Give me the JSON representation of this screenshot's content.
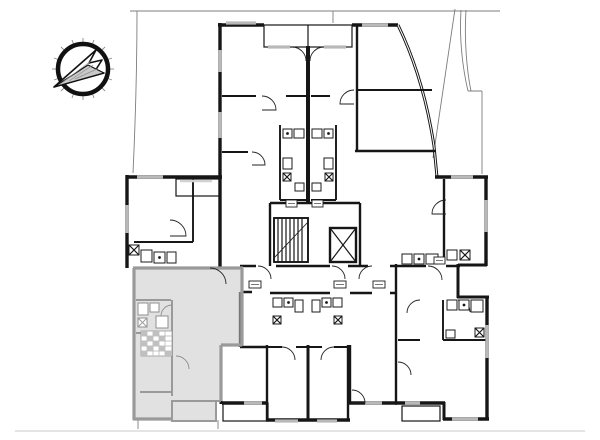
{
  "page": {
    "kind": "architectural-floor-plan",
    "background": "#ffffff"
  },
  "plan": {
    "description": "multi-apartment building storey plan",
    "colors": {
      "walls": "#161616",
      "windows": "#b9b9b9",
      "boundary": "#7d7d7d",
      "highlight_fill": "#c9c9c9",
      "highlight_fill_opacity": "0.55",
      "highlight_wall": "#9a9a9a",
      "background": "#ffffff"
    },
    "icons": {
      "north_arrow": "compass-north-arrow",
      "staircase": "stair-flight-hatching",
      "elevator": "crossed-box"
    },
    "features": {
      "highlighted_unit_position": "bottom-left",
      "core": "central staircase and elevator",
      "balconies": "top recessed balcony, left loggia, three bottom balconies"
    }
  }
}
